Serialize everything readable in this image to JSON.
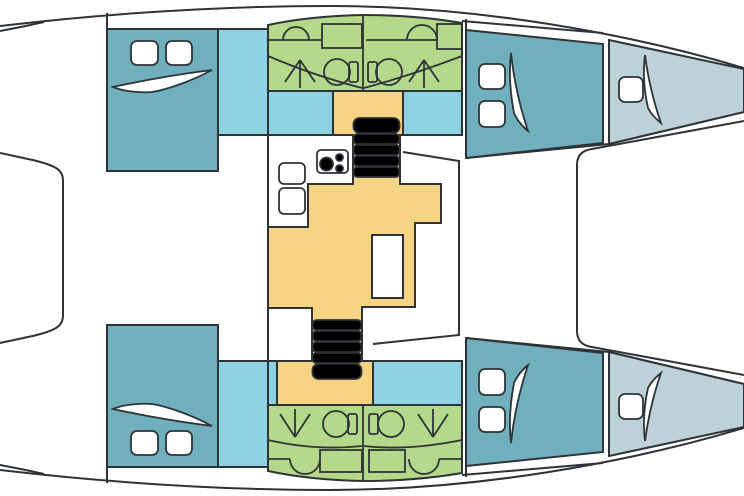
{
  "diagram": {
    "title": "Catamaran interior layout — top view floor plan",
    "type": "boat-floor-plan",
    "orientation": {
      "bow": "right",
      "stern": "left",
      "top_hull": "port",
      "bottom_hull": "starboard"
    },
    "palette": {
      "outline": "#2e3338",
      "hull": "#ffffff",
      "cabin": "#70afbc",
      "passage": "#8fd2e3",
      "bathroom": "#b5d98b",
      "salon": "#f7d384",
      "forepeak": "#bdd1d8"
    },
    "rooms": {
      "port_hull": [
        "aft-double-cabin",
        "passage",
        "aft-head",
        "forward-head",
        "forward-double-cabin",
        "forepeak"
      ],
      "starboard_hull": [
        "aft-double-cabin",
        "passage",
        "aft-head",
        "forward-head",
        "forward-double-cabin",
        "forepeak"
      ],
      "bridgedeck": [
        "galley",
        "salon-floor",
        "salon-table",
        "port-companionway-stairs",
        "starboard-companionway-stairs",
        "foredeck-trampoline",
        "aft-cockpit"
      ]
    },
    "fixtures": {
      "deck_hatches": 10,
      "toilets": 4,
      "showers": 4,
      "bathroom_sinks": 4,
      "vanity_counters": 4,
      "galley_sinks": 2,
      "stove_burners": 3,
      "staircases": 2,
      "stair_steps": 10,
      "tables": 1,
      "cabin_shelves": 6
    }
  }
}
